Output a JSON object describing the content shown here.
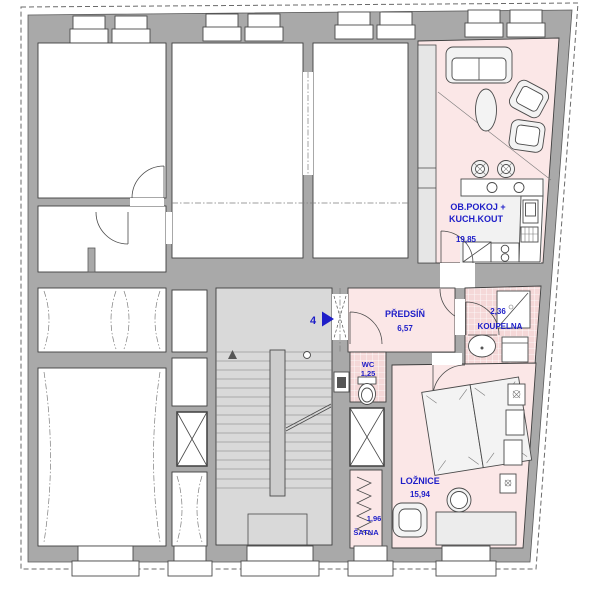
{
  "plan": {
    "unit_marker": {
      "number": "4"
    },
    "rooms": {
      "living_kitchen": {
        "name_line1": "OB.POKOJ +",
        "name_line2": "KUCH.KOUT",
        "area": "19,85"
      },
      "hall": {
        "name": "PŘEDSÍŇ",
        "area": "6,57"
      },
      "bathroom": {
        "name": "KOUPELNA",
        "area": "2,36"
      },
      "wc": {
        "name": "WC",
        "area": "1,25"
      },
      "bedroom": {
        "name": "LOŽNICE",
        "area": "15,94"
      },
      "closet": {
        "name": "ŠATNA",
        "area": "1,96"
      }
    }
  },
  "colors": {
    "wall": "#a9a9a9",
    "room_white": "#ffffff",
    "apartment_pink": "#fbe7e7",
    "tile_pink": "#f5d8d8",
    "stair_fill": "#d9d9d9",
    "label_blue": "#1e1ec8"
  }
}
